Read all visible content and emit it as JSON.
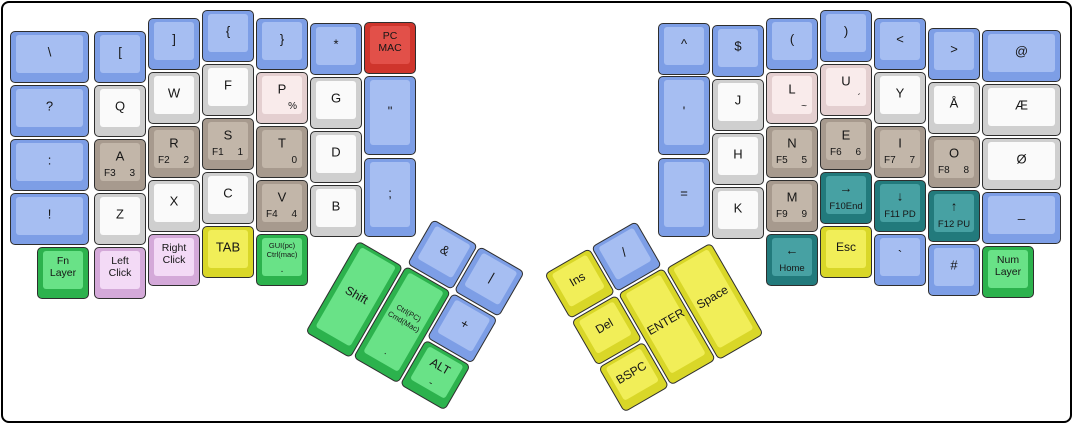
{
  "board": {
    "width": 1073,
    "height": 424,
    "background": "#ffffff",
    "frame_border": "#000000",
    "key_outline": "#2e2e2e",
    "unit_px": 54,
    "key_px": 52
  },
  "palette": {
    "blue": {
      "base": "#7d9ee6",
      "face": "#a6bef2"
    },
    "white": {
      "base": "#cfcfcf",
      "face": "#fafafa"
    },
    "tan": {
      "base": "#a79a8e",
      "face": "#c2b6a9"
    },
    "blush": {
      "base": "#e4cfd0",
      "face": "#f9ebeb"
    },
    "red": {
      "base": "#cf352c",
      "face": "#e25049"
    },
    "green": {
      "base": "#2cb24d",
      "face": "#69e287"
    },
    "orchid": {
      "base": "#d4a9d9",
      "face": "#f3daf6"
    },
    "yellow": {
      "base": "#d9d728",
      "face": "#f1ee58"
    },
    "teal": {
      "base": "#227a7c",
      "face": "#47a1a3"
    }
  },
  "keys": [
    {
      "n": "backslash",
      "l": "\\",
      "c": "blue",
      "x": 10,
      "y": 31,
      "w": 79
    },
    {
      "n": "question",
      "l": "?",
      "c": "blue",
      "x": 10,
      "y": 85,
      "w": 79
    },
    {
      "n": "colon",
      "l": ":",
      "c": "blue",
      "x": 10,
      "y": 139,
      "w": 79
    },
    {
      "n": "exclamation",
      "l": "!",
      "c": "blue",
      "x": 10,
      "y": 193,
      "w": 79
    },
    {
      "n": "fn-layer",
      "l": "Fn\nLayer",
      "c": "green",
      "x": 37,
      "y": 247,
      "sz": "s"
    },
    {
      "n": "left-bracket",
      "l": "[",
      "c": "blue",
      "x": 94,
      "y": 31
    },
    {
      "n": "q",
      "l": "Q",
      "c": "white",
      "x": 94,
      "y": 85
    },
    {
      "n": "a",
      "l": "A",
      "c": "tan",
      "x": 94,
      "y": 139,
      "bl": "F3",
      "br": "3"
    },
    {
      "n": "z",
      "l": "Z",
      "c": "white",
      "x": 94,
      "y": 193
    },
    {
      "n": "left-click",
      "l": "Left\nClick",
      "c": "orchid",
      "x": 94,
      "y": 247,
      "sz": "s"
    },
    {
      "n": "right-bracket",
      "l": "]",
      "c": "blue",
      "x": 148,
      "y": 18
    },
    {
      "n": "w",
      "l": "W",
      "c": "white",
      "x": 148,
      "y": 72
    },
    {
      "n": "r",
      "l": "R",
      "c": "tan",
      "x": 148,
      "y": 126,
      "bl": "F2",
      "br": "2"
    },
    {
      "n": "x",
      "l": "X",
      "c": "white",
      "x": 148,
      "y": 180
    },
    {
      "n": "right-click",
      "l": "Right\nClick",
      "c": "orchid",
      "x": 148,
      "y": 234,
      "sz": "s"
    },
    {
      "n": "left-brace",
      "l": "{",
      "c": "blue",
      "x": 202,
      "y": 10
    },
    {
      "n": "f",
      "l": "F",
      "c": "white",
      "x": 202,
      "y": 64
    },
    {
      "n": "s",
      "l": "S",
      "c": "tan",
      "x": 202,
      "y": 118,
      "bl": "F1",
      "br": "1"
    },
    {
      "n": "c",
      "l": "C",
      "c": "white",
      "x": 202,
      "y": 172
    },
    {
      "n": "tab",
      "l": "TAB",
      "c": "yellow",
      "x": 202,
      "y": 226
    },
    {
      "n": "right-brace",
      "l": "}",
      "c": "blue",
      "x": 256,
      "y": 18
    },
    {
      "n": "p",
      "l": "P",
      "c": "blush",
      "x": 256,
      "y": 72,
      "br": "%"
    },
    {
      "n": "t",
      "l": "T",
      "c": "tan",
      "x": 256,
      "y": 126,
      "br": "0"
    },
    {
      "n": "v",
      "l": "V",
      "c": "tan",
      "x": 256,
      "y": 180,
      "bl": "F4",
      "br": "4"
    },
    {
      "n": "gui-ctrl",
      "l": "GUI(pc)\nCtrl(mac)",
      "c": "green",
      "x": 256,
      "y": 234,
      "sz": "xs",
      "bc": "."
    },
    {
      "n": "asterisk",
      "l": "*",
      "c": "blue",
      "x": 310,
      "y": 23
    },
    {
      "n": "g",
      "l": "G",
      "c": "white",
      "x": 310,
      "y": 77
    },
    {
      "n": "d",
      "l": "D",
      "c": "white",
      "x": 310,
      "y": 131
    },
    {
      "n": "b",
      "l": "B",
      "c": "white",
      "x": 310,
      "y": 185
    },
    {
      "n": "pc-mac",
      "l": "PC\nMAC",
      "c": "red",
      "x": 364,
      "y": 22,
      "sz": "s"
    },
    {
      "n": "double-quote",
      "l": "\"",
      "c": "blue",
      "x": 364,
      "y": 76,
      "h": 79
    },
    {
      "n": "semicolon",
      "l": ";",
      "c": "blue",
      "x": 364,
      "y": 158,
      "h": 79
    },
    {
      "n": "caret",
      "l": "^",
      "c": "blue",
      "x": 658,
      "y": 23
    },
    {
      "n": "apostrophe",
      "l": "'",
      "c": "blue",
      "x": 658,
      "y": 76,
      "h": 79
    },
    {
      "n": "equals",
      "l": "=",
      "c": "blue",
      "x": 658,
      "y": 158,
      "h": 79
    },
    {
      "n": "dollar",
      "l": "$",
      "c": "blue",
      "x": 712,
      "y": 25
    },
    {
      "n": "j",
      "l": "J",
      "c": "white",
      "x": 712,
      "y": 79
    },
    {
      "n": "h",
      "l": "H",
      "c": "white",
      "x": 712,
      "y": 133
    },
    {
      "n": "k",
      "l": "K",
      "c": "white",
      "x": 712,
      "y": 187
    },
    {
      "n": "left-paren",
      "l": "(",
      "c": "blue",
      "x": 766,
      "y": 18
    },
    {
      "n": "l",
      "l": "L",
      "c": "blush",
      "x": 766,
      "y": 72,
      "br": "~"
    },
    {
      "n": "n",
      "l": "N",
      "c": "tan",
      "x": 766,
      "y": 126,
      "bl": "F5",
      "br": "5"
    },
    {
      "n": "m",
      "l": "M",
      "c": "tan",
      "x": 766,
      "y": 180,
      "bl": "F9",
      "br": "9"
    },
    {
      "n": "home",
      "l": "←",
      "c": "teal",
      "x": 766,
      "y": 234,
      "bc": "Home"
    },
    {
      "n": "right-paren",
      "l": ")",
      "c": "blue",
      "x": 820,
      "y": 10
    },
    {
      "n": "u",
      "l": "U",
      "c": "blush",
      "x": 820,
      "y": 64,
      "br": "´"
    },
    {
      "n": "e",
      "l": "E",
      "c": "tan",
      "x": 820,
      "y": 118,
      "bl": "F6",
      "br": "6"
    },
    {
      "n": "f10-end",
      "l": "→",
      "c": "teal",
      "x": 820,
      "y": 172,
      "bc": "F10End"
    },
    {
      "n": "esc",
      "l": "Esc",
      "c": "yellow",
      "x": 820,
      "y": 226,
      "sz": "m"
    },
    {
      "n": "less-than",
      "l": "<",
      "c": "blue",
      "x": 874,
      "y": 18
    },
    {
      "n": "y",
      "l": "Y",
      "c": "white",
      "x": 874,
      "y": 72
    },
    {
      "n": "i",
      "l": "I",
      "c": "tan",
      "x": 874,
      "y": 126,
      "bl": "F7",
      "br": "7"
    },
    {
      "n": "f11-pd",
      "l": "↓",
      "c": "teal",
      "x": 874,
      "y": 180,
      "bc": "F11 PD"
    },
    {
      "n": "backtick",
      "l": "`",
      "c": "blue",
      "x": 874,
      "y": 234
    },
    {
      "n": "greater-than",
      "l": ">",
      "c": "blue",
      "x": 928,
      "y": 28
    },
    {
      "n": "a-ring",
      "l": "Å",
      "c": "white",
      "x": 928,
      "y": 82
    },
    {
      "n": "o",
      "l": "O",
      "c": "tan",
      "x": 928,
      "y": 136,
      "bl": "F8",
      "br": "8"
    },
    {
      "n": "f12-pu",
      "l": "↑",
      "c": "teal",
      "x": 928,
      "y": 190,
      "bc": "F12 PU"
    },
    {
      "n": "hash",
      "l": "#",
      "c": "blue",
      "x": 928,
      "y": 244
    },
    {
      "n": "at",
      "l": "@",
      "c": "blue",
      "x": 982,
      "y": 30,
      "w": 79
    },
    {
      "n": "ae",
      "l": "Æ",
      "c": "white",
      "x": 982,
      "y": 84,
      "w": 79
    },
    {
      "n": "o-slash",
      "l": "Ø",
      "c": "white",
      "x": 982,
      "y": 138,
      "w": 79
    },
    {
      "n": "underscore",
      "l": "_",
      "c": "blue",
      "x": 982,
      "y": 192,
      "w": 79
    },
    {
      "n": "num-layer",
      "l": "Num\nLayer",
      "c": "green",
      "x": 982,
      "y": 246,
      "sz": "s"
    }
  ],
  "thumb_clusters": [
    {
      "name": "left-thumb-cluster",
      "origin": [
        433,
        219
      ],
      "angle": 30,
      "keys": [
        {
          "n": "ampersand",
          "l": "&",
          "c": "blue",
          "x": 0,
          "y": 0
        },
        {
          "n": "pipe",
          "l": "|",
          "c": "blue",
          "x": 54,
          "y": 0
        },
        {
          "n": "plus",
          "l": "+",
          "c": "blue",
          "x": 54,
          "y": 54
        },
        {
          "n": "alt",
          "l": "ALT",
          "c": "green",
          "x": 54,
          "y": 108,
          "sz": "m",
          "bc": "-"
        },
        {
          "n": "ctrl-cmd",
          "l": "Ctrl(PC)\nCmd(Mac)",
          "c": "green",
          "x": 0,
          "y": 54,
          "h": 106,
          "sz": "xs",
          "bc": "."
        },
        {
          "n": "shift",
          "l": "Shift",
          "c": "green",
          "x": -54,
          "y": 56,
          "h": 106,
          "sz": "m"
        }
      ]
    },
    {
      "name": "right-thumb-cluster",
      "origin": [
        591,
        247
      ],
      "angle": -30,
      "keys": [
        {
          "n": "slash",
          "l": "/",
          "c": "blue",
          "x": 0,
          "y": 0
        },
        {
          "n": "ins",
          "l": "Ins",
          "c": "yellow",
          "x": -54,
          "y": 0,
          "sz": "m"
        },
        {
          "n": "del",
          "l": "Del",
          "c": "yellow",
          "x": -54,
          "y": 54,
          "sz": "m"
        },
        {
          "n": "bspc",
          "l": "BSPC",
          "c": "yellow",
          "x": -54,
          "y": 108,
          "sz": "m"
        },
        {
          "n": "enter",
          "l": "ENTER",
          "c": "yellow",
          "x": 0,
          "y": 54,
          "h": 106,
          "sz": "m"
        },
        {
          "n": "space",
          "l": "Space",
          "c": "yellow",
          "x": 54,
          "y": 56,
          "h": 106,
          "sz": "m"
        }
      ]
    }
  ]
}
